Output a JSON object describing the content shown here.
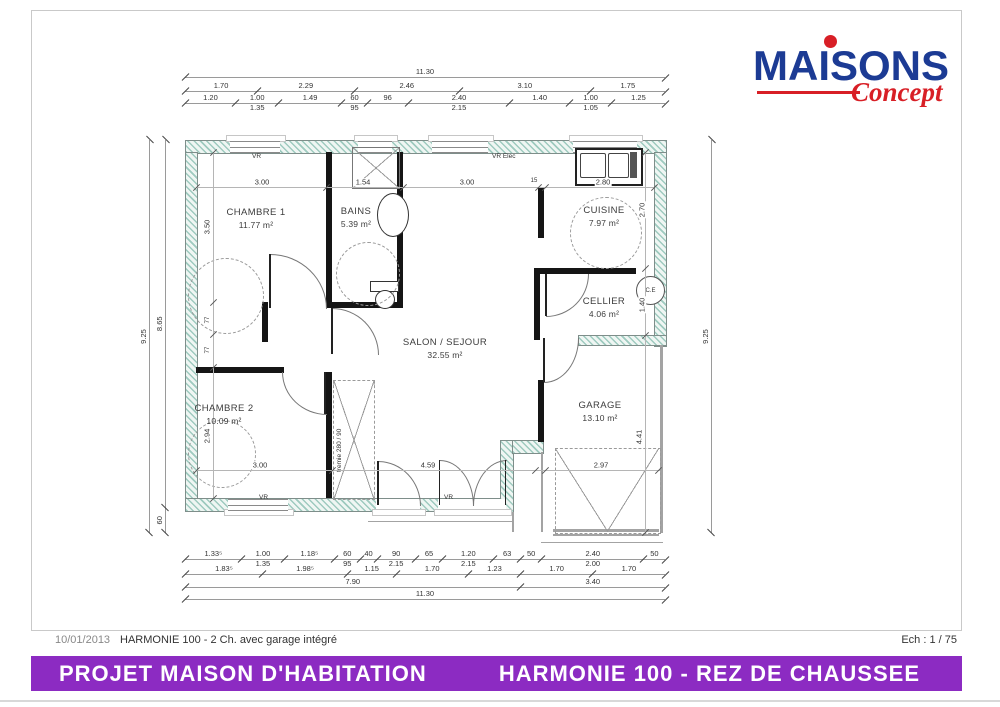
{
  "logo": {
    "brand": "MAISONS",
    "script": "Concept",
    "brand_color": "#1c3b94",
    "accent_color": "#d81f26"
  },
  "titleblock": {
    "date": "10/01/2013",
    "model": "HARMONIE 100 - 2 Ch. avec garage intégré",
    "scale": "Ech : 1 / 75"
  },
  "footer": {
    "left": "PROJET MAISON D'HABITATION",
    "right": "HARMONIE 100  - REZ DE CHAUSSEE",
    "bar_color": "#8c2bc2"
  },
  "plan": {
    "rooms": {
      "chambre1": {
        "name": "CHAMBRE 1",
        "area": "11.77 m²"
      },
      "bains": {
        "name": "BAINS",
        "area": "5.39 m²"
      },
      "cuisine": {
        "name": "CUISINE",
        "area": "7.97 m²"
      },
      "cellier": {
        "name": "CELLIER",
        "area": "4.06 m²"
      },
      "salon": {
        "name": "SALON / SEJOUR",
        "area": "32.55 m²"
      },
      "chambre2": {
        "name": "CHAMBRE 2",
        "area": "10.09 m²"
      },
      "garage": {
        "name": "GARAGE",
        "area": "13.10 m²"
      }
    },
    "labels": {
      "vr": "VR",
      "vr_elec": "VR Elec",
      "ce": "C.E",
      "tremie": "tremie 280 / 90"
    },
    "dims": {
      "c1_w": "3.00",
      "bains_w": "1.54",
      "hall_w": "3.00",
      "kwall": "15",
      "cuisine_w": "2.80",
      "c2_w": "3.00",
      "sejour_w": "4.59",
      "garage_w": "2.97",
      "c1_h": "3.50",
      "d77a": "77",
      "d77b": "77",
      "c2_h": "2.94",
      "cuisine_h": "2.70",
      "cellier_h": "1.40",
      "garage_h": "4.41"
    }
  },
  "chains": {
    "top1": [
      {
        "v": 11.3,
        "l": "11.30"
      }
    ],
    "top2": [
      {
        "v": 1.7,
        "l": "1.70"
      },
      {
        "v": 2.29,
        "l": "2.29"
      },
      {
        "v": 2.46,
        "l": "2.46"
      },
      {
        "v": 3.1,
        "l": "3.10"
      },
      {
        "v": 1.75,
        "l": "1.75"
      }
    ],
    "top3": [
      {
        "v": 1.2,
        "l": "1.20"
      },
      {
        "v": 1.0,
        "l": "1.00",
        "l2": "1.35"
      },
      {
        "v": 1.49,
        "l": "1.49"
      },
      {
        "v": 0.6,
        "l": "60",
        "l2": "95"
      },
      {
        "v": 0.96,
        "l": "96"
      },
      {
        "v": 2.4,
        "l": "2.40",
        "l2": "2.15"
      },
      {
        "v": 1.4,
        "l": "1.40"
      },
      {
        "v": 1.0,
        "l": "1.00",
        "l2": "1.05"
      },
      {
        "v": 1.25,
        "l": "1.25"
      }
    ],
    "bot1": [
      {
        "v": 1.335,
        "l": "1.33⁵"
      },
      {
        "v": 1.0,
        "l": "1.00",
        "l2": "1.35"
      },
      {
        "v": 1.185,
        "l": "1.18⁵"
      },
      {
        "v": 0.6,
        "l": "60",
        "l2": "95"
      },
      {
        "v": 0.4,
        "l": "40"
      },
      {
        "v": 0.9,
        "l": "90",
        "l2": "2.15"
      },
      {
        "v": 0.65,
        "l": "65"
      },
      {
        "v": 1.2,
        "l": "1.20",
        "l2": "2.15"
      },
      {
        "v": 0.63,
        "l": "63"
      },
      {
        "v": 0.5,
        "l": "50"
      },
      {
        "v": 2.4,
        "l": "2.40",
        "l2": "2.00"
      },
      {
        "v": 0.5,
        "l": "50"
      }
    ],
    "bot2": [
      {
        "v": 1.835,
        "l": "1.83⁵"
      },
      {
        "v": 1.985,
        "l": "1.98⁵"
      },
      {
        "v": 1.15,
        "l": "1.15"
      },
      {
        "v": 1.7,
        "l": "1.70"
      },
      {
        "v": 1.23,
        "l": "1.23"
      },
      {
        "v": 1.7,
        "l": "1.70"
      },
      {
        "v": 1.7,
        "l": "1.70"
      }
    ],
    "bot3": [
      {
        "v": 7.9,
        "l": "7.90"
      },
      {
        "v": 3.4,
        "l": "3.40"
      }
    ],
    "bot4": [
      {
        "v": 11.3,
        "l": "11.30"
      }
    ],
    "left_outer": [
      {
        "v": 9.25,
        "l": "9.25"
      }
    ],
    "left_inner": [
      {
        "v": 0.6,
        "l": "60"
      },
      {
        "v": 8.65,
        "l": "8.65"
      }
    ],
    "right": [
      {
        "v": 9.25,
        "l": "9.25"
      }
    ]
  }
}
